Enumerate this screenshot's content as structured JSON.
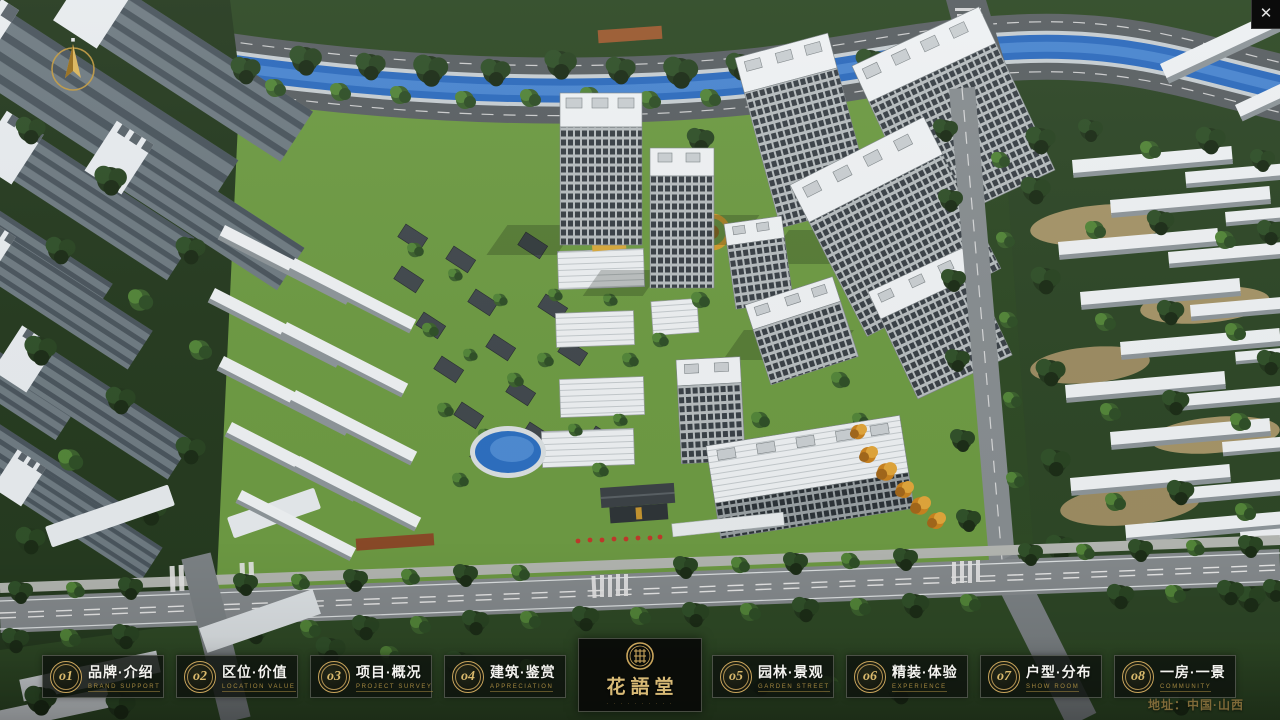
{
  "window": {
    "close_icon": "✕"
  },
  "compass": {
    "meaning": "north-arrow"
  },
  "logo": {
    "title": "花語堂",
    "tagline": "· · · · · · · · · ·"
  },
  "nav": {
    "items": [
      {
        "no": "o1",
        "zh": "品牌·介绍",
        "en": "BRAND SUPPORT"
      },
      {
        "no": "o2",
        "zh": "区位·价值",
        "en": "LOCATION VALUE"
      },
      {
        "no": "o3",
        "zh": "项目·概况",
        "en": "PROJECT SURVEY"
      },
      {
        "no": "o4",
        "zh": "建筑·鉴赏",
        "en": "APPRECIATION"
      },
      {
        "no": "o5",
        "zh": "园林·景观",
        "en": "GARDEN STREET"
      },
      {
        "no": "o6",
        "zh": "精装·体验",
        "en": "EXPERIENCE"
      },
      {
        "no": "o7",
        "zh": "户型·分布",
        "en": "SHOW ROOM"
      },
      {
        "no": "o8",
        "zh": "一房·一景",
        "en": "COMMUNITY"
      }
    ]
  },
  "footer": {
    "address": "地址：中国·山西"
  },
  "colors": {
    "accent_gold": "#c9a55c",
    "bar_background": "rgba(14,18,13,0.82)",
    "river_blue": "#2d6bbd"
  }
}
